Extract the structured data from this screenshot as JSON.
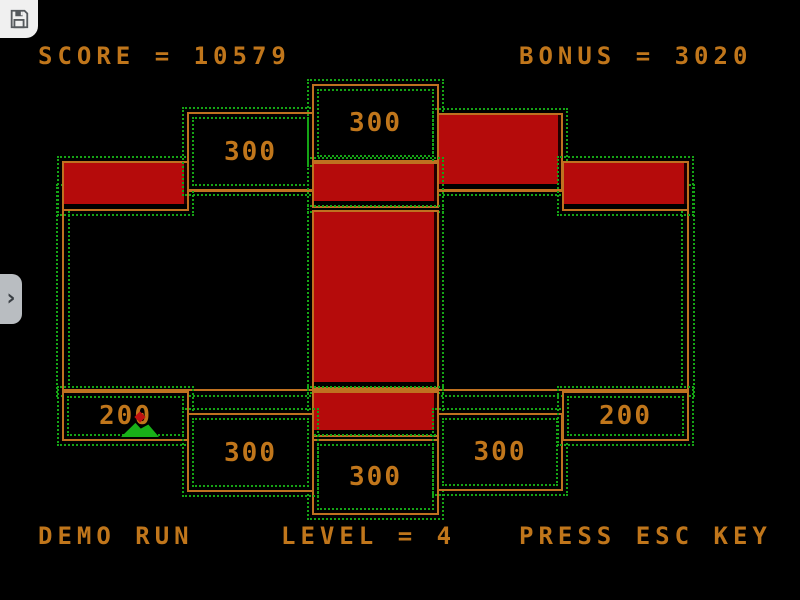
{
  "hud": {
    "score": {
      "text": "SCORE = 10579",
      "value": 10579
    },
    "bonus": {
      "text": "BONUS = 3020",
      "value": 3020
    },
    "demo_run": "DEMO RUN",
    "level": {
      "text": "LEVEL = 4",
      "value": 4
    },
    "press_esc": "PRESS ESC KEY"
  },
  "board": {
    "labels": {
      "top_left_300": "300",
      "top_center_300": "300",
      "bottom_left_200": "200",
      "bottom_left_300": "300",
      "bottom_center_300": "300",
      "bottom_right_300": "300",
      "bottom_right_200": "200"
    },
    "colors": {
      "claimed_red": "#b50b0b",
      "outline_orange": "#bf7120",
      "dots_green": "#15a415",
      "text_orange": "#c0761b",
      "background": "#000000",
      "sprite_green": "#18b018",
      "sprite_red": "#c01010"
    }
  },
  "overlay": {
    "save_button": {
      "icon": "floppy-icon"
    },
    "expand_tab": {
      "icon": "chevron-right-icon",
      "glyph": "›"
    }
  }
}
